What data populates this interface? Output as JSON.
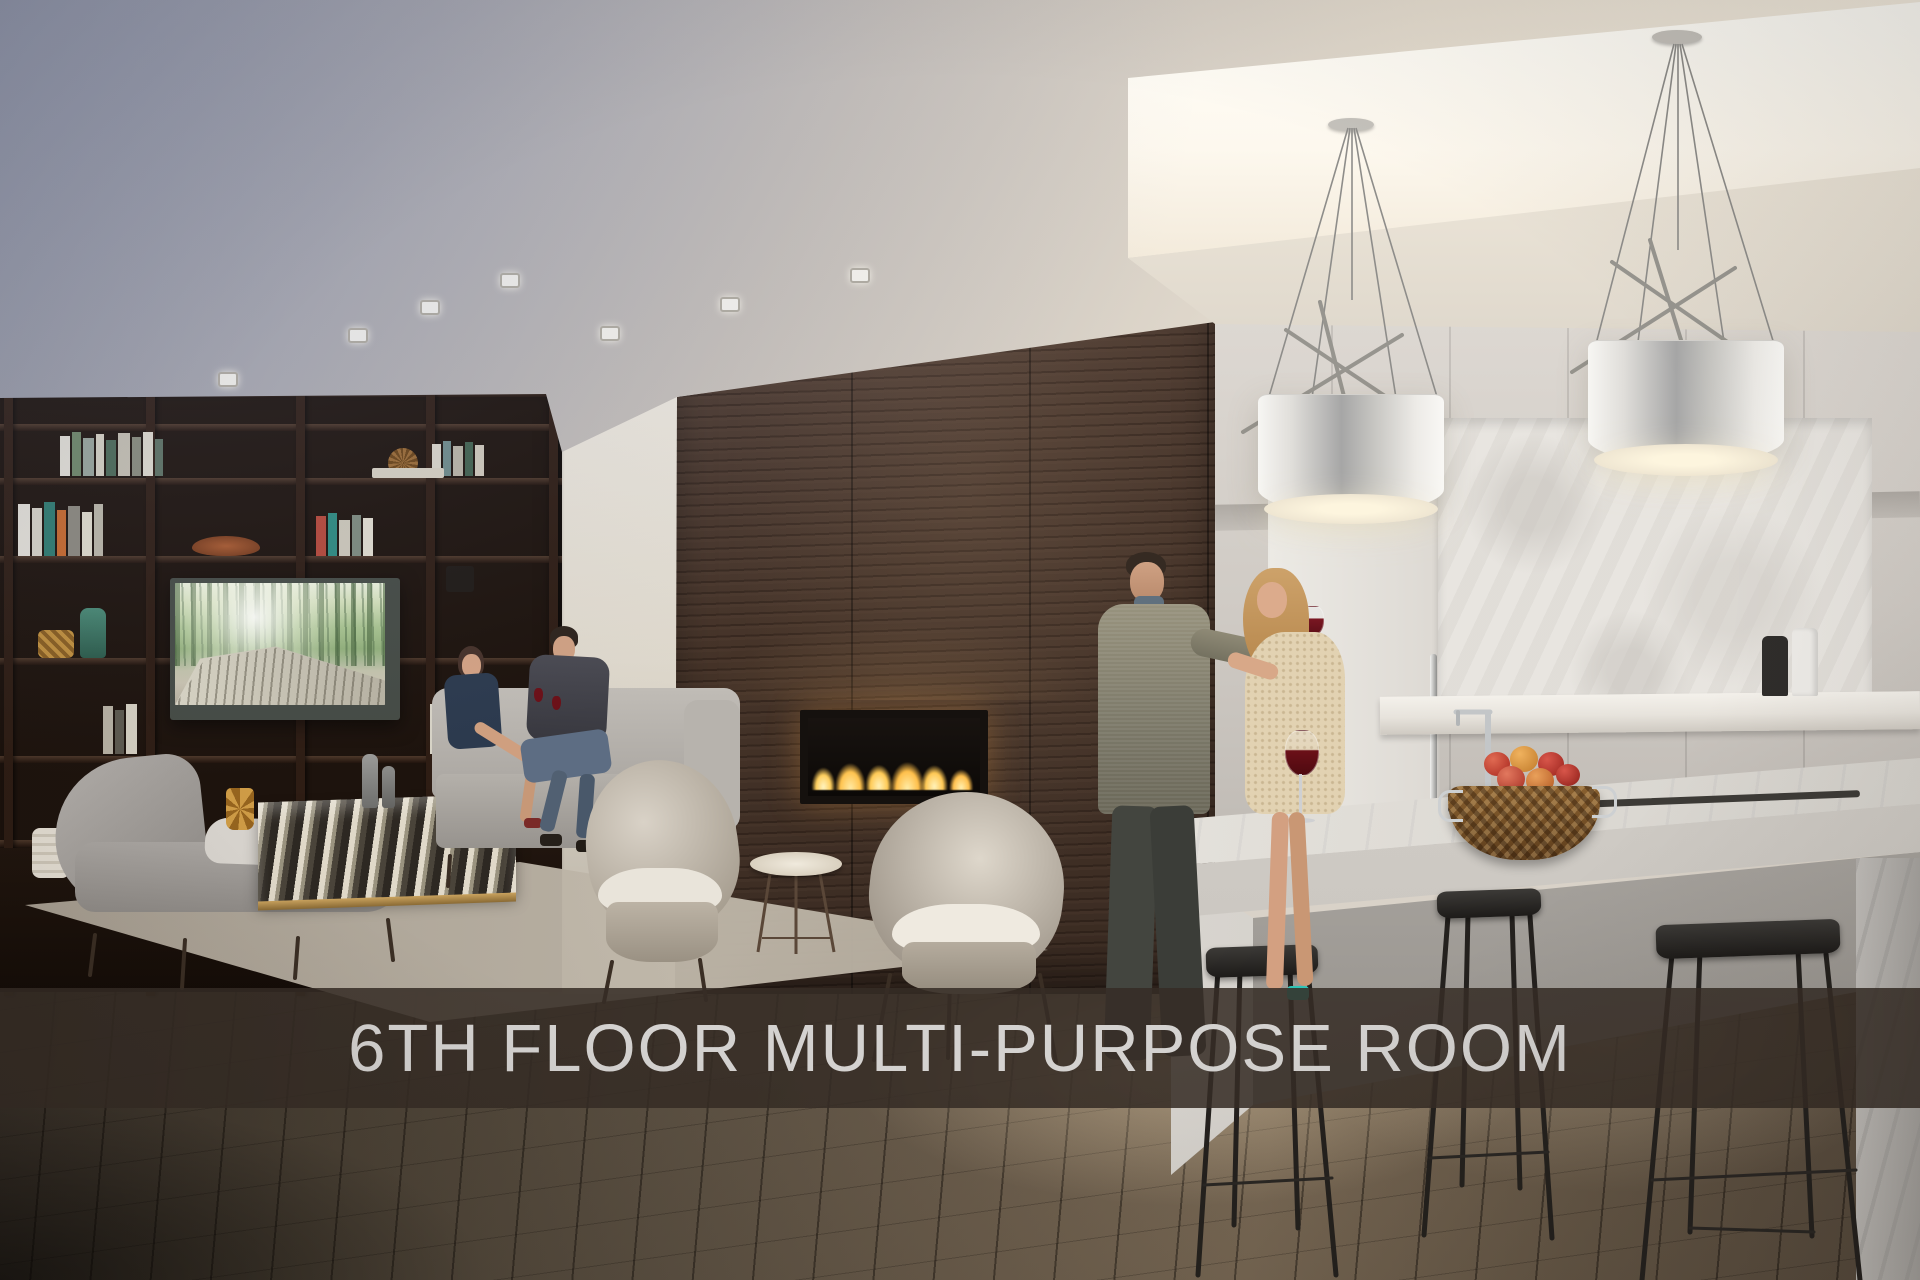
{
  "banner": {
    "title": "6TH FLOOR MULTI-PURPOSE ROOM"
  },
  "palette": {
    "banner_background": "#352c25",
    "banner_text": "#d4d2d0",
    "ceiling_cool": "#9196a8",
    "ceiling_warm": "#f3ecdf",
    "cove_light": "#fffef9",
    "bookshelf_wood": "#1d130d",
    "feature_wood_wall": "#46352a",
    "fireplace_flame": "#ffc84f",
    "kitchen_cabinets": "#d0cbc5",
    "marble_backsplash": "#e7e4df",
    "island_marble": "#eceae4",
    "stool_metal": "#24211e",
    "floor_dark": "#332c25",
    "floor_light": "#796955",
    "armchair_fabric": "#cfc8bb",
    "rug": "#b0a799"
  },
  "scene": {
    "regions": [
      "ceiling",
      "cove-lighting",
      "bookshelf-wall",
      "tv-screen",
      "white-wall",
      "fireplace-wall",
      "fireplace",
      "kitchen-cabinets",
      "marble-backsplash",
      "kitchen-island",
      "fruit-basket",
      "pendant-lights",
      "bar-stools",
      "chaise-lounge",
      "stone-coffee-table",
      "armchairs",
      "side-table",
      "area-rug",
      "wood-floor",
      "seated-couple",
      "standing-couple",
      "caption-banner"
    ]
  }
}
